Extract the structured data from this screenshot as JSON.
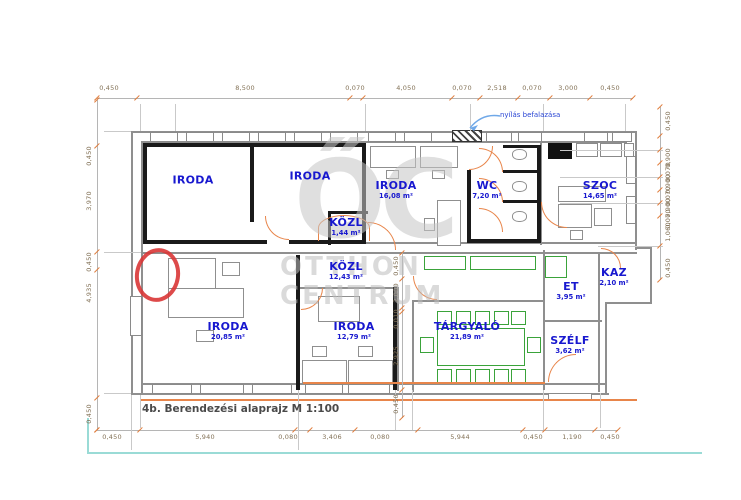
{
  "title": {
    "scale_label": "4b. Berendezési alaprajz M 1:100"
  },
  "annotation": {
    "masonry_note": "nyílás befalazása"
  },
  "watermark": {
    "monogram": "ŐC",
    "line1": "OTTHON",
    "line2": "CENTRUM"
  },
  "colors": {
    "label_blue": "#1818cf",
    "door_orange": "#e8854a",
    "furniture_green": "#3aa33a",
    "annotation_red": "#d93636",
    "dim_text": "#837257",
    "guide_teal": "#9adbd6"
  },
  "rooms": [
    {
      "name": "IRODA",
      "area": "",
      "x": 193,
      "y": 181
    },
    {
      "name": "IRODA",
      "area": "",
      "x": 310,
      "y": 177
    },
    {
      "name": "IRODA",
      "area": "16,08 m²",
      "x": 396,
      "y": 190
    },
    {
      "name": "WC",
      "area": "7,20 m²",
      "x": 487,
      "y": 190
    },
    {
      "name": "SZOC",
      "area": "14,65 m²",
      "x": 600,
      "y": 190
    },
    {
      "name": "KÖZL",
      "area": "1,44 m²",
      "x": 346,
      "y": 227
    },
    {
      "name": "KÖZL",
      "area": "12,43 m²",
      "x": 346,
      "y": 271
    },
    {
      "name": "ET",
      "area": "3,95 m²",
      "x": 571,
      "y": 291
    },
    {
      "name": "KAZ",
      "area": "2,10 m²",
      "x": 614,
      "y": 277
    },
    {
      "name": "TÁRGYALÓ",
      "area": "21,89 m²",
      "x": 467,
      "y": 331
    },
    {
      "name": "SZÉLF",
      "area": "3,62 m²",
      "x": 570,
      "y": 345
    },
    {
      "name": "IRODA",
      "area": "20,85 m²",
      "x": 228,
      "y": 331
    },
    {
      "name": "IRODA",
      "area": "12,79 m²",
      "x": 354,
      "y": 331
    }
  ],
  "dimensions": {
    "top": {
      "items": [
        {
          "v": "0,450",
          "x": 109
        },
        {
          "v": "8,500",
          "x": 245
        },
        {
          "v": "0,070",
          "x": 355
        },
        {
          "v": "4,050",
          "x": 406
        },
        {
          "v": "0,070",
          "x": 462
        },
        {
          "v": "2,518",
          "x": 497
        },
        {
          "v": "0,070",
          "x": 532
        },
        {
          "v": "3,000",
          "x": 568
        },
        {
          "v": "0,450",
          "x": 610
        }
      ]
    },
    "bottom": {
      "items": [
        {
          "v": "0,450",
          "x": 112
        },
        {
          "v": "5,940",
          "x": 205
        },
        {
          "v": "0,080",
          "x": 288
        },
        {
          "v": "3,406",
          "x": 332
        },
        {
          "v": "0,080",
          "x": 380
        },
        {
          "v": "5,944",
          "x": 460
        },
        {
          "v": "0,450",
          "x": 533
        },
        {
          "v": "1,190",
          "x": 572
        },
        {
          "v": "0,450",
          "x": 610
        }
      ]
    },
    "left": {
      "items": [
        {
          "v": "0,450",
          "y": 156
        },
        {
          "v": "3,970",
          "y": 201
        },
        {
          "v": "0,450",
          "y": 262
        },
        {
          "v": "4,935",
          "y": 293
        },
        {
          "v": "0,450",
          "y": 414
        }
      ]
    },
    "right": {
      "items": [
        {
          "v": "0,450",
          "y": 121
        },
        {
          "v": "0,900",
          "y": 158
        },
        {
          "v": "0,070",
          "y": 172
        },
        {
          "v": "0,900",
          "y": 184
        },
        {
          "v": "0,070",
          "y": 196
        },
        {
          "v": "0,900",
          "y": 208
        },
        {
          "v": "0,070",
          "y": 219
        },
        {
          "v": "1,060",
          "y": 232
        },
        {
          "v": "0,450",
          "y": 268
        }
      ]
    },
    "inner": {
      "items": [
        {
          "v": "0,450",
          "y": 266
        },
        {
          "v": "2,000",
          "y": 293
        },
        {
          "v": "0,010",
          "y": 319
        },
        {
          "v": "2,925",
          "y": 356
        },
        {
          "v": "0,450",
          "y": 404
        }
      ]
    }
  }
}
